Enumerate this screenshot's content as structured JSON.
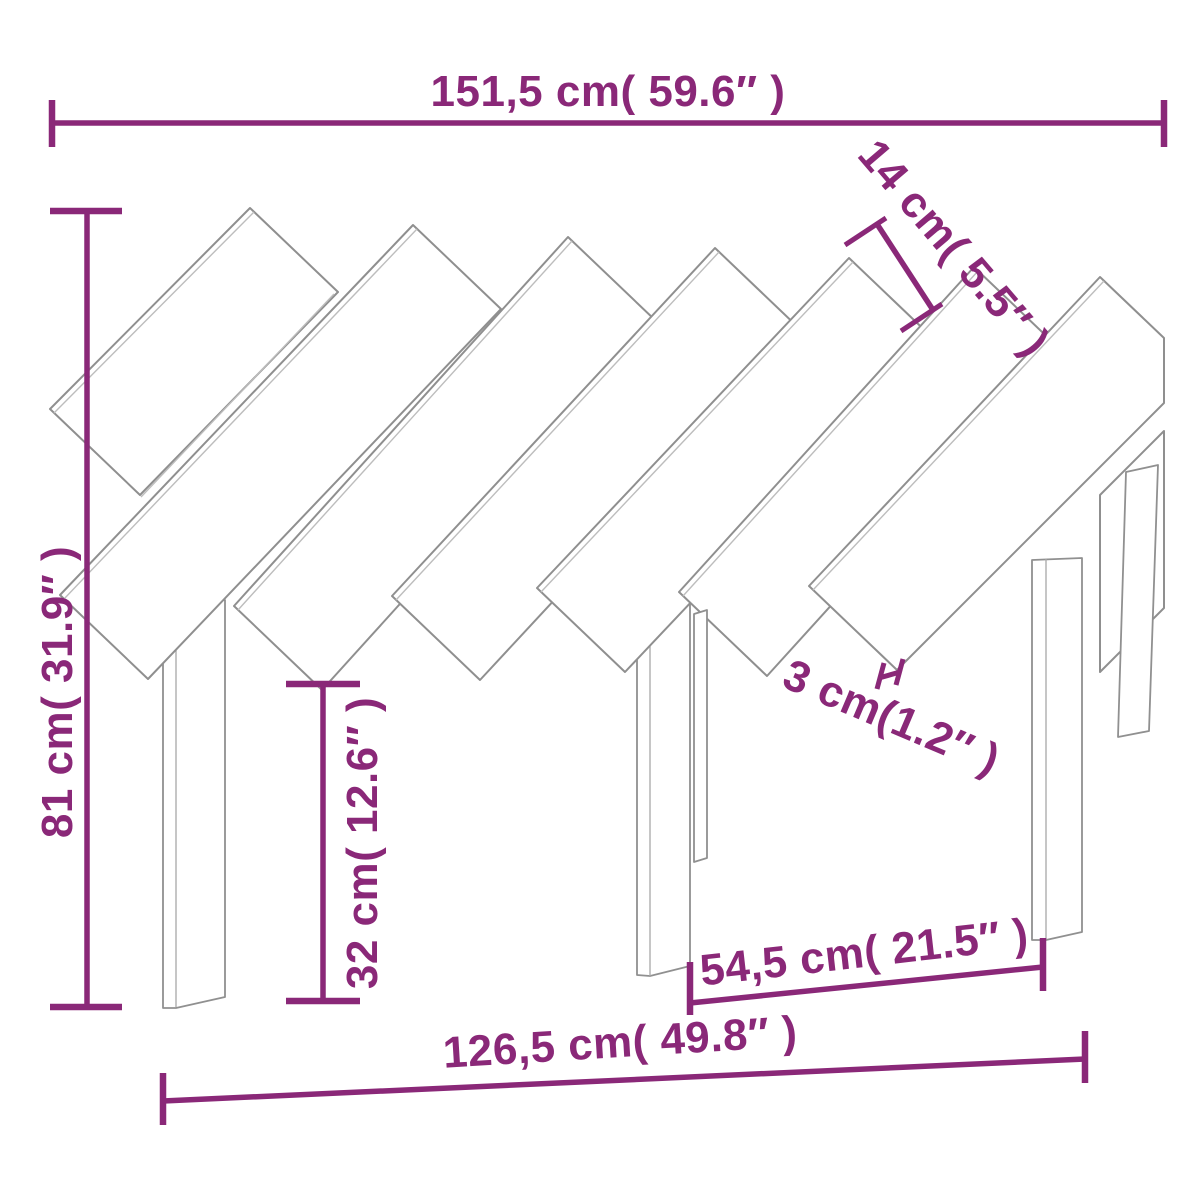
{
  "figure": {
    "kind": "product dimension diagram",
    "product": "wooden headboard with diagonal slats and three legs",
    "background": "#ffffff"
  },
  "colors": {
    "dimension_accent": "#8a2878",
    "drawing_stroke": "#8f8f8f"
  },
  "dimensions": {
    "overall_width": "151,5 cm( 59.6″ )",
    "overall_height": "81 cm( 31.9″ )",
    "slat_width": "14 cm( 5.5″ )",
    "slat_gap": "3 cm(1.2″ )",
    "leg_height": "32 cm( 12.6″ )",
    "inner_span": "54,5 cm( 21.5″ )",
    "base_width": "126,5 cm( 49.8″ )"
  }
}
